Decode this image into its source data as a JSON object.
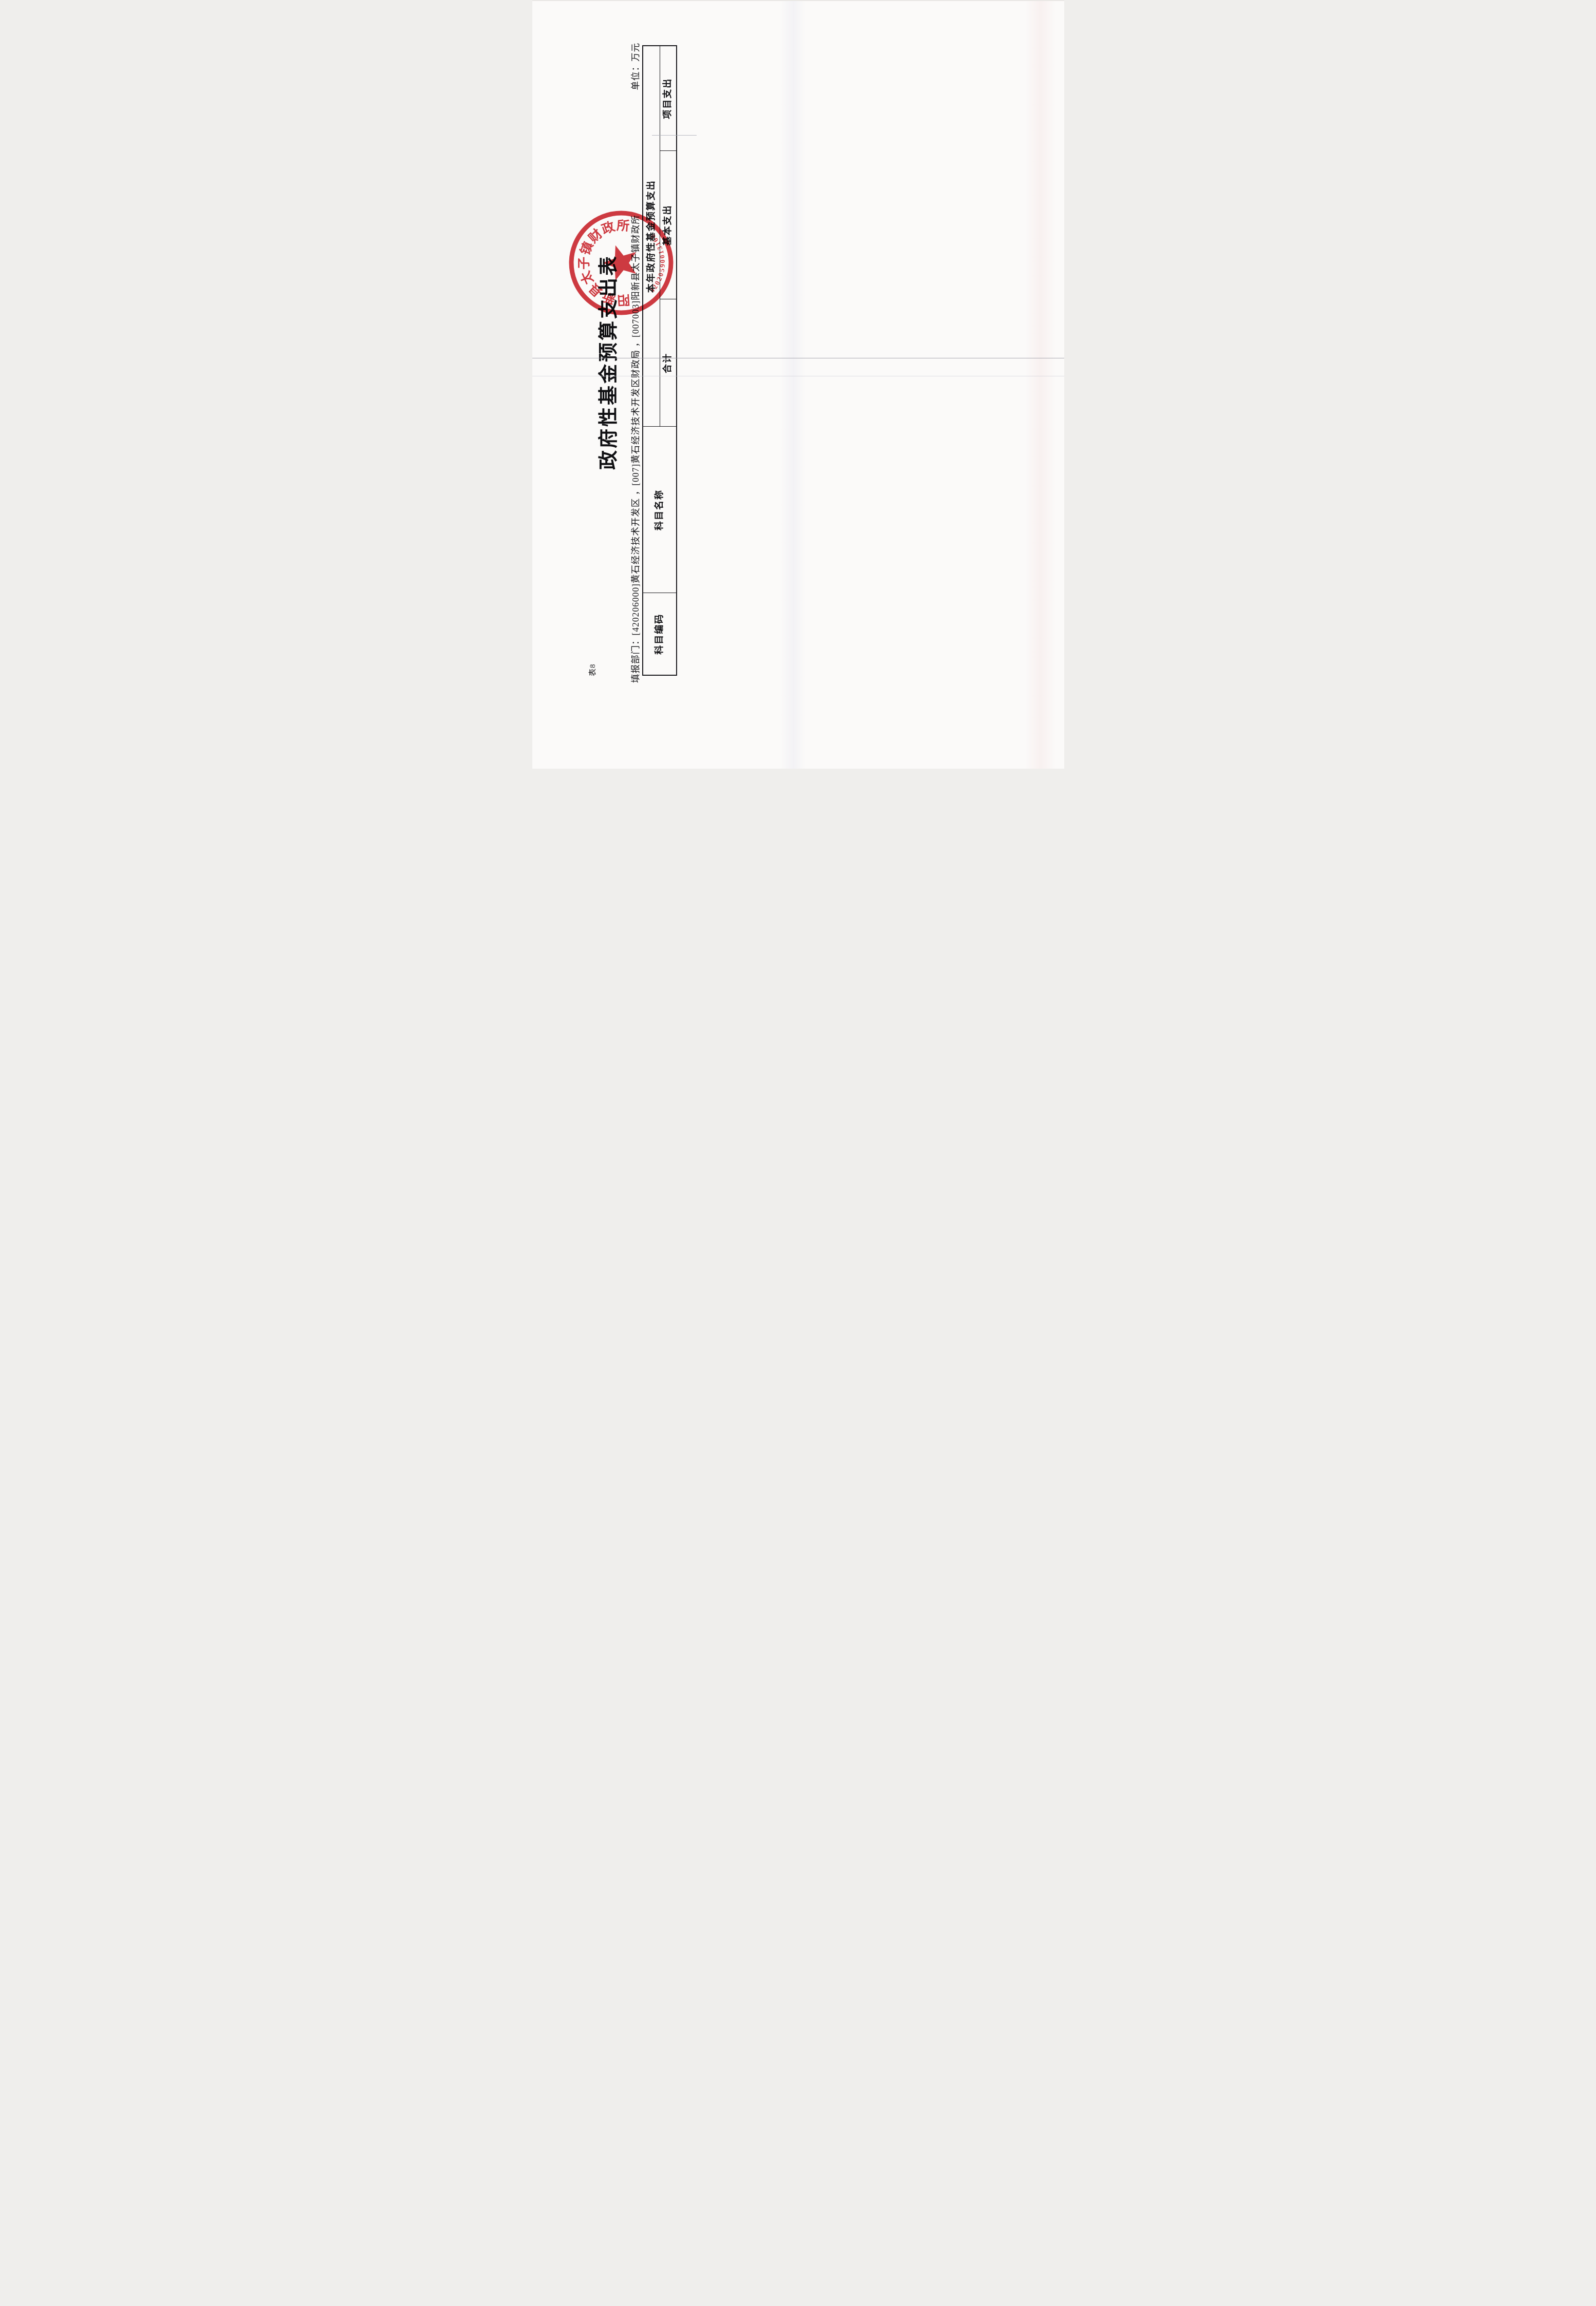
{
  "document": {
    "kind": "scanned budget statement, landscape sheet rotated 90° CCW in scan",
    "background_color": "#fbfaf9",
    "ink_color": "#1c1c20"
  },
  "sheet_label": "表8",
  "title": "政府性基金预算支出表",
  "meta": {
    "department_line": "填报部门：[420206000]黄石经济技术开发区 ，[007]黄石经济技术开发区财政局 ，[007003]阳新县太子镇财政所",
    "unit_label": "单位：万元"
  },
  "table": {
    "header": {
      "col_subject_code": "科目编码",
      "col_subject_name": "科目名称",
      "group_current_year": "本年政府性基金预算支出",
      "col_total": "合计",
      "col_basic": "基本支出",
      "col_project": "项目支出"
    },
    "rows": []
  },
  "seal": {
    "ring_text": "阳新县太子镇财政所",
    "code": "42020590013168",
    "color": "#c8242c"
  }
}
